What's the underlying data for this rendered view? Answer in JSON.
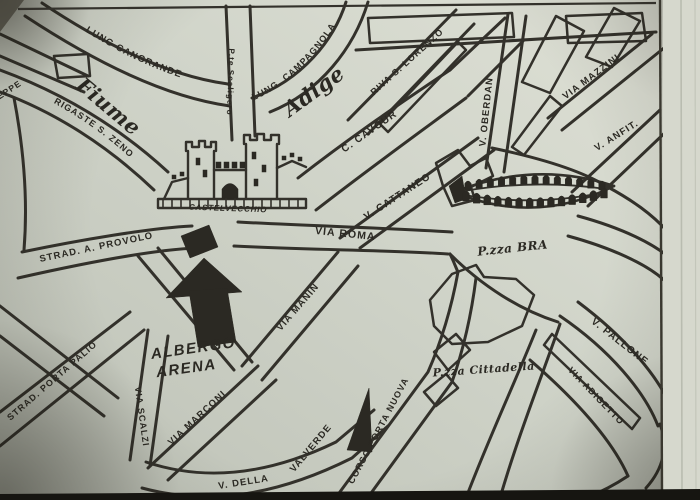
{
  "map": {
    "ink_color": "#33312b",
    "paper_color": "#d0d4c9",
    "labels_straight": [
      {
        "name": "street-label-seppe",
        "t": "SEPPE",
        "x": 8,
        "y": 94,
        "r": -33,
        "s": 8.5
      },
      {
        "name": "street-label-pte-scaligero",
        "t": "P.te Scaligero",
        "x": 228,
        "y": 82,
        "r": 92,
        "s": 8
      },
      {
        "name": "street-label-riva-s-lorenzo",
        "t": "RIVA S. LORENZO",
        "x": 409,
        "y": 64,
        "r": -42,
        "s": 9
      },
      {
        "name": "street-label-v-oberdan",
        "t": "V. OBERDAN",
        "x": 489,
        "y": 112,
        "r": -84,
        "s": 9.5
      },
      {
        "name": "street-label-via-mazzini",
        "t": "VIA MAZZINI",
        "x": 593,
        "y": 79,
        "r": -37,
        "s": 9.5
      },
      {
        "name": "street-label-v-anfit",
        "t": "V. ANFIT.",
        "x": 618,
        "y": 138,
        "r": -32,
        "s": 9.5
      },
      {
        "name": "river-label-fiume",
        "t": "Fiume",
        "x": 104,
        "y": 112,
        "r": 40,
        "s": 21,
        "c": "script"
      },
      {
        "name": "river-label-adige",
        "t": "Adige",
        "x": 318,
        "y": 97,
        "r": -36,
        "s": 21,
        "c": "script"
      },
      {
        "name": "street-label-c-cavour",
        "t": "C. CAVOUR",
        "x": 371,
        "y": 134,
        "r": -35,
        "s": 10
      },
      {
        "name": "street-label-v-cattaneo",
        "t": "V. CATTANEO",
        "x": 399,
        "y": 199,
        "r": -33,
        "s": 10
      },
      {
        "name": "street-label-via-roma",
        "t": "VIA ROMA",
        "x": 345,
        "y": 237,
        "r": 6,
        "s": 10.5
      },
      {
        "name": "landmark-label-castelvecchio",
        "t": "CASTELVECCHIO",
        "x": 228,
        "y": 211,
        "r": 2,
        "s": 8,
        "c": "castel"
      },
      {
        "name": "square-label-pzza-bra",
        "t": "P.zza BRA",
        "x": 513,
        "y": 252,
        "r": -6,
        "s": 12,
        "c": "script"
      },
      {
        "name": "street-label-strad-a-provolo",
        "t": "STRAD. A. PROVOLO",
        "x": 97,
        "y": 250,
        "r": -12,
        "s": 9.5
      },
      {
        "name": "hotel-label-albergo",
        "t": "ALBERGO",
        "x": 194,
        "y": 353,
        "r": -8,
        "s": 15,
        "c": "heavy"
      },
      {
        "name": "hotel-label-arena",
        "t": "ARENA",
        "x": 187,
        "y": 373,
        "r": -8,
        "s": 15,
        "c": "heavy"
      },
      {
        "name": "street-label-strad-porta-palio",
        "t": "STRAD. PORTA PALIO",
        "x": 54,
        "y": 383,
        "r": -41,
        "s": 9
      },
      {
        "name": "street-label-via-scalzi",
        "t": "VIA SCALZI",
        "x": 139,
        "y": 417,
        "r": 82,
        "s": 9
      },
      {
        "name": "street-label-via-marconi",
        "t": "VIA MARCONI",
        "x": 199,
        "y": 420,
        "r": -43,
        "s": 9.5
      },
      {
        "name": "street-label-via-manin",
        "t": "VIA MANIN",
        "x": 300,
        "y": 309,
        "r": -49,
        "s": 9.5
      },
      {
        "name": "street-label-valverde",
        "t": "VALVERDE",
        "x": 313,
        "y": 450,
        "r": -50,
        "s": 9.5
      },
      {
        "name": "street-label-v-della",
        "t": "V. DELLA",
        "x": 244,
        "y": 485,
        "r": -9,
        "s": 9.5
      },
      {
        "name": "street-label-corso-porta-nuova",
        "t": "CORSO PORTA NUOVA",
        "x": 381,
        "y": 432,
        "r": -62,
        "s": 9
      },
      {
        "name": "square-label-pzza-cittadella",
        "t": "P.zza Cittadella",
        "x": 484,
        "y": 373,
        "r": -4,
        "s": 11,
        "c": "script"
      },
      {
        "name": "street-label-v-pallone",
        "t": "V. PALLONE",
        "x": 618,
        "y": 344,
        "r": 38,
        "s": 10
      },
      {
        "name": "street-label-via-adigetto",
        "t": "VIA ADIGETTO",
        "x": 594,
        "y": 398,
        "r": 46,
        "s": 9
      }
    ],
    "labels_curved": [
      {
        "name": "street-label-lung-cangrande",
        "t": "LUNG  CANGRANDE",
        "d": "M 80,28 Q 150,74 226,90",
        "s": 9.5,
        "o": 6
      },
      {
        "name": "street-label-lung-campagnola",
        "t": "LUNG.  CAMPAGNOLA",
        "d": "M 250,102 Q 306,78 344,12",
        "s": 9,
        "o": 4
      },
      {
        "name": "street-label-rigaste-s-zeno",
        "t": "RIGASTE S. ZENO",
        "d": "M 48,100 Q 108,132 146,174",
        "s": 9,
        "o": 6
      }
    ],
    "roads": [
      {
        "name": "road-lungadige-cangrande-outer",
        "d": "M 42,3 C 105,45 168,76 228,84"
      },
      {
        "name": "road-lungadige-cangrande-inner",
        "d": "M 25,16 C 95,62 165,97 230,106"
      },
      {
        "name": "road-lungadige-campagnola-inner",
        "d": "M 252,98 C 302,80 334,40 346,2"
      },
      {
        "name": "road-lungadige-campagnola-outer",
        "d": "M 270,112 C 320,92 354,48 368,2"
      },
      {
        "name": "road-ponte-scaligero-left",
        "d": "M 226,6 L 232,140"
      },
      {
        "name": "road-ponte-scaligero-right",
        "d": "M 250,6 L 255,136"
      },
      {
        "name": "road-rigaste-s-zeno-upper",
        "d": "M 0,70 C 60,92 118,126 168,172"
      },
      {
        "name": "road-rigaste-s-zeno-lower",
        "d": "M 0,92 C 55,112 108,146 154,190"
      },
      {
        "name": "road-seppe-upper",
        "d": "M 0,34 L 88,76"
      },
      {
        "name": "road-seppe-lower",
        "d": "M 0,56 L 84,92"
      },
      {
        "name": "road-left-edge",
        "d": "M 14,98 C 24,150 28,200 24,250"
      },
      {
        "name": "road-provolo-upper",
        "d": "M 22,252 C 80,240 150,228 192,226"
      },
      {
        "name": "road-provolo-lower",
        "d": "M 18,278 C 80,264 150,250 196,248"
      },
      {
        "name": "road-hotel-diag-right",
        "d": "M 158,248 L 252,362"
      },
      {
        "name": "road-hotel-diag-left",
        "d": "M 138,256 L 234,370"
      },
      {
        "name": "road-via-scalzi-left",
        "d": "M 148,330 L 130,460"
      },
      {
        "name": "road-via-scalzi-right",
        "d": "M 168,336 L 150,466"
      },
      {
        "name": "road-porta-palio-upper",
        "d": "M 0,412 L 130,312"
      },
      {
        "name": "road-porta-palio-lower",
        "d": "M 0,446 L 144,330"
      },
      {
        "name": "road-cross-upper",
        "d": "M 0,306 L 118,398"
      },
      {
        "name": "road-cross-lower",
        "d": "M 0,336 L 104,416"
      },
      {
        "name": "road-via-marconi-upper",
        "d": "M 148,468 L 258,366"
      },
      {
        "name": "road-via-marconi-lower",
        "d": "M 168,480 L 276,380"
      },
      {
        "name": "road-v-della-upper",
        "d": "M 146,462 C 200,480 262,478 336,442 L 374,410"
      },
      {
        "name": "road-v-della-lower",
        "d": "M 142,488 C 205,505 272,498 352,458 L 388,426"
      },
      {
        "name": "road-corso-porta-nuova-left",
        "d": "M 334,500 L 428,372 C 442,340 452,305 458,272"
      },
      {
        "name": "road-corso-porta-nuova-right",
        "d": "M 366,500 L 452,382 C 464,348 472,310 476,278"
      },
      {
        "name": "road-via-manin-left",
        "d": "M 242,366 L 338,252"
      },
      {
        "name": "road-via-manin-right",
        "d": "M 262,380 L 358,266"
      },
      {
        "name": "road-via-roma-upper",
        "d": "M 238,222 C 310,226 390,228 452,232"
      },
      {
        "name": "road-via-roma-lower",
        "d": "M 234,246 C 310,250 390,250 448,254"
      },
      {
        "name": "road-v-cattaneo-upper",
        "d": "M 340,238 L 478,138"
      },
      {
        "name": "road-v-cattaneo-lower",
        "d": "M 360,248 L 494,150"
      },
      {
        "name": "road-c-cavour-upper",
        "d": "M 298,178 C 352,136 402,102 450,70"
      },
      {
        "name": "road-c-cavour-lower",
        "d": "M 316,210 C 370,168 420,132 466,98"
      },
      {
        "name": "road-cavour-conn-upper",
        "d": "M 450,70 L 505,18"
      },
      {
        "name": "road-cavour-conn-lower",
        "d": "M 468,96 L 524,40"
      },
      {
        "name": "road-v-oberdan-left",
        "d": "M 508,14 L 486,168"
      },
      {
        "name": "road-v-oberdan-right",
        "d": "M 526,16 L 504,172"
      },
      {
        "name": "road-riva-s-lorenzo-left",
        "d": "M 348,120 L 456,10"
      },
      {
        "name": "road-riva-s-lorenzo-right",
        "d": "M 368,134 L 474,24"
      },
      {
        "name": "road-top-street",
        "d": "M 356,50 L 656,32"
      },
      {
        "name": "road-via-mazzini-upper",
        "d": "M 548,118 L 652,34"
      },
      {
        "name": "road-via-mazzini-lower",
        "d": "M 562,130 L 664,48"
      },
      {
        "name": "road-v-anfit-upper",
        "d": "M 572,192 L 660,110"
      },
      {
        "name": "road-v-anfit-lower",
        "d": "M 588,206 L 672,126"
      },
      {
        "name": "road-bra-east-upper",
        "d": "M 578,216 C 622,228 655,244 672,260"
      },
      {
        "name": "road-bra-east-lower",
        "d": "M 568,236 C 612,248 646,264 664,280"
      },
      {
        "name": "road-bra-south",
        "d": "M 450,254 C 482,286 520,310 558,322"
      },
      {
        "name": "road-v-pallone-upper",
        "d": "M 560,316 C 610,350 645,392 658,426"
      },
      {
        "name": "road-v-pallone-lower",
        "d": "M 578,302 C 626,338 660,378 672,410"
      },
      {
        "name": "road-via-adigetto-lower",
        "d": "M 530,360 C 576,400 612,440 628,476"
      },
      {
        "name": "road-cittadella-south-left",
        "d": "M 536,330 C 516,380 488,440 466,498"
      },
      {
        "name": "road-cittadella-south-right",
        "d": "M 560,324 C 542,376 518,436 500,498"
      },
      {
        "name": "road-bra-north",
        "d": "M 492,148 C 540,158 580,170 606,186"
      },
      {
        "name": "road-bra-north-2",
        "d": "M 606,186 C 632,200 652,214 668,232"
      },
      {
        "name": "road-bra-west-conn",
        "d": "M 450,254 C 454,262 456,268 458,272"
      },
      {
        "name": "road-bottom-right-1",
        "d": "M 628,476 C 610,488 596,494 586,498"
      },
      {
        "name": "road-bottom-right-2",
        "d": "M 660,424 C 668,446 664,468 646,488"
      }
    ],
    "outlines": [
      {
        "name": "block-river-small",
        "p": "54,56 88,54 90,76 58,78"
      },
      {
        "name": "block-top-1",
        "p": "368,18 512,13 514,37 370,43"
      },
      {
        "name": "block-top-2",
        "p": "566,16 642,13 646,41 568,43"
      },
      {
        "name": "block-ne-1",
        "p": "522,82 556,16 584,31 550,93"
      },
      {
        "name": "block-ne-2",
        "p": "586,57 614,8 640,21 612,67"
      },
      {
        "name": "block-mazzini-sliver",
        "p": "512,147 550,96 562,106 524,155"
      },
      {
        "name": "block-riva-sliver",
        "p": "380,124 458,42 466,50 388,132"
      },
      {
        "name": "block-bra-west",
        "p": "436,163 458,150 470,166 486,158 493,176 471,187 475,200 452,206 443,186"
      },
      {
        "name": "block-cittadella-main",
        "p": "430,300 452,274 476,265 484,277 516,279 534,295 522,326 488,342 452,344 434,326"
      },
      {
        "name": "block-cittadella-small-1",
        "p": "434,352 456,334 470,350 448,370"
      },
      {
        "name": "block-cittadella-small-2",
        "p": "424,392 446,374 458,388 436,406"
      },
      {
        "name": "block-pallone-sliver",
        "p": "552,334 640,418 632,429 544,345"
      }
    ],
    "detail_paths": [
      {
        "name": "castelvecchio-base",
        "d": "M 158,199 L 306,199 L 306,208 L 158,208 Z",
        "w": 2.4
      },
      {
        "name": "castelvecchio-tower-left",
        "d": "M 188,199 L 188,151 M 214,199 L 214,151 M 186,151 L 186,142 L 192,142 L 192,147 L 199,147 L 199,141 L 205,141 L 205,147 L 211,147 L 211,142 L 216,142 L 216,151",
        "w": 2.4
      },
      {
        "name": "castelvecchio-tower-right",
        "d": "M 246,199 L 246,144 M 277,199 L 277,144 M 244,144 L 244,135 L 250,135 L 250,140 L 257,140 L 257,134 L 264,134 L 264,140 L 271,140 L 271,135 L 279,135 L 279,144",
        "w": 2.4
      },
      {
        "name": "castelvecchio-centre-wall",
        "d": "M 214,170 L 246,170",
        "w": 2.4
      },
      {
        "name": "castelvecchio-wing-left",
        "d": "M 188,178 L 172,182 L 164,199",
        "w": 2.4
      },
      {
        "name": "castelvecchio-wing-right",
        "d": "M 277,168 L 292,161 L 306,167",
        "w": 2.4
      },
      {
        "name": "arena-outline-top",
        "d": "M 454,192 Q 535,160 614,186",
        "w": 2.6
      },
      {
        "name": "arena-outline-bottom",
        "d": "M 454,192 Q 535,226 614,186",
        "w": 2.6
      },
      {
        "name": "arena-band-top",
        "d": "M 464,191 Q 535,179 606,189",
        "w": 1.8
      },
      {
        "name": "arena-band-bottom",
        "d": "M 464,195 Q 535,207 606,192",
        "w": 1.8
      }
    ],
    "fills": [
      {
        "name": "albergo-arena-arrow-head",
        "p": "204,258 166,298 242,292"
      },
      {
        "name": "albergo-arena-arrow-shaft",
        "p": "189,291 227,288 236,342 198,347"
      },
      {
        "name": "albergo-arena-hotel-building",
        "p": "181,236 209,225 218,247 190,258"
      },
      {
        "name": "porta-nuova-monument",
        "p": "347,450 369,388 372,452"
      },
      {
        "name": "arena-west-cap",
        "p": "449,186 462,176 466,199 455,203"
      }
    ],
    "fill_paths": [
      {
        "name": "castelvecchio-gate",
        "d": "M 222,199 L 222,189 Q 230,178 238,189 L 238,199 Z"
      }
    ],
    "squares": [
      {
        "x": 216,
        "y": 162,
        "w": 5,
        "h": 6
      },
      {
        "x": 224,
        "y": 162,
        "w": 5,
        "h": 6
      },
      {
        "x": 232,
        "y": 162,
        "w": 5,
        "h": 6
      },
      {
        "x": 240,
        "y": 162,
        "w": 5,
        "h": 6
      },
      {
        "x": 196,
        "y": 158,
        "w": 4,
        "h": 7
      },
      {
        "x": 203,
        "y": 170,
        "w": 4,
        "h": 7
      },
      {
        "x": 252,
        "y": 152,
        "w": 4,
        "h": 7
      },
      {
        "x": 262,
        "y": 165,
        "w": 4,
        "h": 7
      },
      {
        "x": 254,
        "y": 179,
        "w": 4,
        "h": 7
      },
      {
        "x": 172,
        "y": 175,
        "w": 4,
        "h": 4
      },
      {
        "x": 180,
        "y": 172,
        "w": 4,
        "h": 4
      },
      {
        "x": 282,
        "y": 156,
        "w": 4,
        "h": 4
      },
      {
        "x": 290,
        "y": 153,
        "w": 4,
        "h": 4
      },
      {
        "x": 298,
        "y": 157,
        "w": 4,
        "h": 4
      }
    ],
    "base_ticks": {
      "x0": 163,
      "x1": 303,
      "step": 9,
      "y0": 199,
      "y1": 208
    },
    "arch_rows": [
      {
        "name": "arena-arches-top",
        "p0": [
          468,
          190
        ],
        "p1": [
          535,
          178
        ],
        "p2": [
          602,
          190
        ],
        "n": 13,
        "h": 10,
        "w": 3.2
      },
      {
        "name": "arena-arches-bottom",
        "p0": [
          466,
          201
        ],
        "p1": [
          535,
          216
        ],
        "p2": [
          604,
          198
        ],
        "n": 14,
        "h": 11,
        "w": 3.4
      }
    ]
  }
}
